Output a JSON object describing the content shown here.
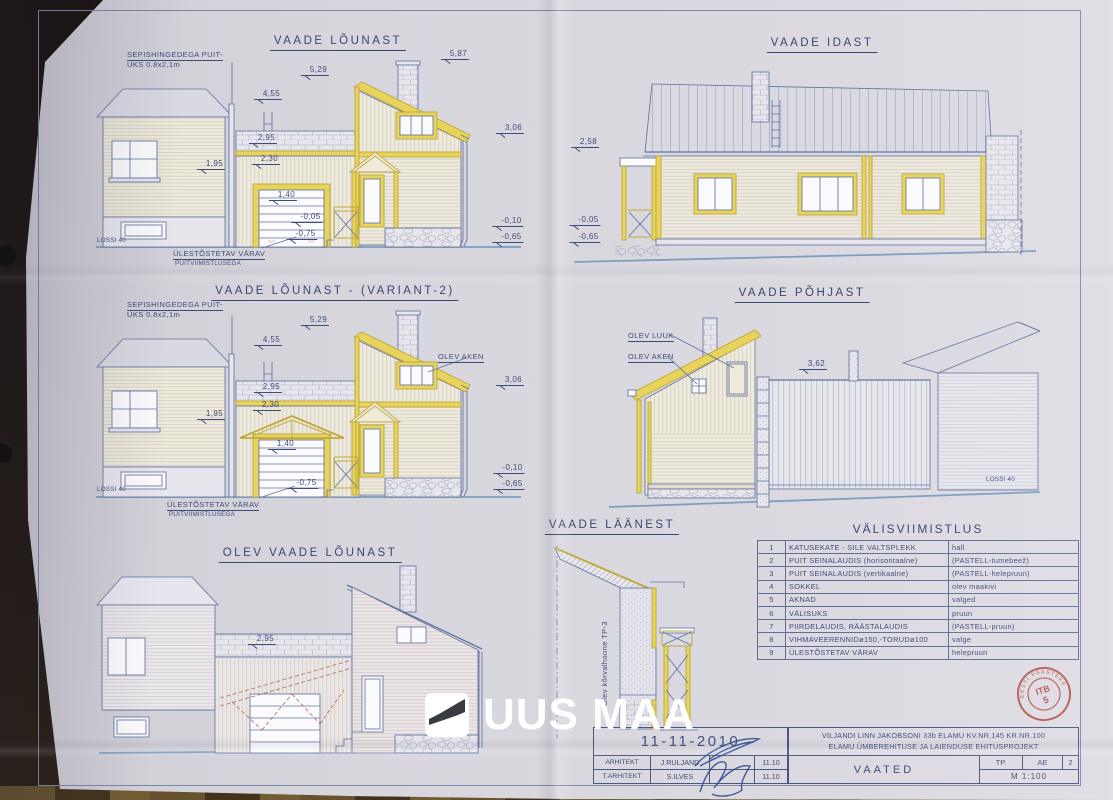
{
  "logo": {
    "text": "UUS MAA"
  },
  "stamp": {
    "line1": "ITB",
    "line2": "5",
    "arc": "EESTI PÄÄSTEKESKUS"
  },
  "finish_table": {
    "title": "VÄLISVIIMISTLUS",
    "rows": [
      [
        "1",
        "KATUSEKATE - SILE VALTSPLEKK",
        "hall"
      ],
      [
        "2",
        "PUIT SEINALAUDIS (horisontaalne)",
        "(PASTELL-tumebeež)"
      ],
      [
        "3",
        "PUIT SEINALAUDIS (vertikaalne)",
        "(PASTELL-helepruun)"
      ],
      [
        "4",
        "SOKKEL",
        "olev maakivi"
      ],
      [
        "5",
        "AKNAD",
        "valged"
      ],
      [
        "6",
        "VÄLISUKS",
        "pruun"
      ],
      [
        "7",
        "PIIRDELAUDIS, RÄÄSTALAUDIS",
        "(PASTELL-pruun)"
      ],
      [
        "8",
        "VIHMAVEERENNIDø150,-TORUDø100",
        "valge"
      ],
      [
        "9",
        "ÜLESTÕSTETAV VÄRAV",
        "helepruun"
      ]
    ]
  },
  "title_block": {
    "date": "11-11-2010",
    "arhitekt_label": "ARHITEKT",
    "arhitekt_name": "J.RULJAND",
    "arhitekt_date": "11.10",
    "t_arhitekt_label": "T.ARHITEKT",
    "t_arhitekt_name": "S.ILVES",
    "t_arhitekt_date": "11.10",
    "project_line1": "VILJANDI LINN   JAKOBSONI 33b ELAMU KV.NR.145 KR.NR.100",
    "project_line2": "ELAMU ÜMBEREHITUSE JA LAIENDUSE   EHITUSPROJEKT",
    "sheet_title": "VAATED",
    "stage": "TP.",
    "doc_type": "AE",
    "sheet_no": "2",
    "scale": "M 1:100"
  },
  "annotations": [
    {
      "name": "view-title-vaade-lounast",
      "text": "VAADE LÕUNAST",
      "x": 338,
      "y": 36,
      "cls": "vtitle",
      "al": "c"
    },
    {
      "name": "view-title-vaade-idast",
      "text": "VAADE IDAST",
      "x": 822,
      "y": 38,
      "cls": "vtitle",
      "al": "c"
    },
    {
      "name": "view-title-variant2",
      "text": "VAADE LÕUNAST - (VARIANT-2)",
      "x": 335,
      "y": 286,
      "cls": "vtitle",
      "al": "c"
    },
    {
      "name": "view-title-vaade-pohjast",
      "text": "VAADE PÕHJAST",
      "x": 802,
      "y": 288,
      "cls": "vtitle",
      "al": "c"
    },
    {
      "name": "view-title-olev-vaade-lounast",
      "text": "OLEV VAADE LÕUNAST",
      "x": 310,
      "y": 548,
      "cls": "vtitle",
      "al": "c"
    },
    {
      "name": "view-title-vaade-laanest",
      "text": "VAADE LÄÄNEST",
      "x": 612,
      "y": 520,
      "cls": "vtitle",
      "al": "c"
    },
    {
      "name": "label-sepis-uks-line1",
      "text": "SEPISHINGEDEGA PUIT-",
      "x": 127,
      "y": 51,
      "cls": "lbl u",
      "al": "l"
    },
    {
      "name": "label-sepis-uks-line2",
      "text": "UKS 0.8x2,1m",
      "x": 127,
      "y": 61,
      "cls": "lbl",
      "al": "l"
    },
    {
      "name": "dim-label",
      "text": "5,87",
      "x": 455,
      "y": 50,
      "cls": "dim",
      "al": "c"
    },
    {
      "name": "dim-label",
      "text": "5,29",
      "x": 315,
      "y": 66,
      "cls": "dim",
      "al": "c"
    },
    {
      "name": "dim-label",
      "text": "4,55",
      "x": 268,
      "y": 90,
      "cls": "dim",
      "al": "c"
    },
    {
      "name": "dim-label",
      "text": "2,95",
      "x": 263,
      "y": 134,
      "cls": "dim",
      "al": "c"
    },
    {
      "name": "dim-label",
      "text": "2,30",
      "x": 266,
      "y": 155,
      "cls": "dim",
      "al": "c"
    },
    {
      "name": "dim-label",
      "text": "1,95",
      "x": 211,
      "y": 160,
      "cls": "dim",
      "al": "c"
    },
    {
      "name": "dim-label",
      "text": "1,40",
      "x": 283,
      "y": 191,
      "cls": "dim",
      "al": "c"
    },
    {
      "name": "dim-label",
      "text": "-0,05",
      "x": 307,
      "y": 213,
      "cls": "dim",
      "al": "c"
    },
    {
      "name": "dim-label",
      "text": "-0,75",
      "x": 302,
      "y": 230,
      "cls": "dim",
      "al": "c"
    },
    {
      "name": "dim-label",
      "text": "3,06",
      "x": 510,
      "y": 124,
      "cls": "dim",
      "al": "c"
    },
    {
      "name": "dim-label",
      "text": "-0,10",
      "x": 508,
      "y": 217,
      "cls": "dim",
      "al": "c"
    },
    {
      "name": "dim-label",
      "text": "-0,65",
      "x": 508,
      "y": 233,
      "cls": "dim",
      "al": "c"
    },
    {
      "name": "label-ulestostetav-varav",
      "text": "ÜLESTÕSTETAV VÄRAV",
      "x": 173,
      "y": 250,
      "cls": "lbl u",
      "al": "l"
    },
    {
      "name": "label-puitviimistlusega",
      "text": "PUITVIIMISTLUSEGA",
      "x": 175,
      "y": 261,
      "cls": "sm",
      "al": "l"
    },
    {
      "name": "label-lossi-40",
      "text": "LOSSI 40",
      "x": 97,
      "y": 238,
      "cls": "sm",
      "al": "l"
    },
    {
      "name": "dim-label",
      "text": "2,58",
      "x": 585,
      "y": 138,
      "cls": "dim",
      "al": "c"
    },
    {
      "name": "dim-label",
      "text": "-0,05",
      "x": 585,
      "y": 216,
      "cls": "dim",
      "al": "c"
    },
    {
      "name": "dim-label",
      "text": "-0,65",
      "x": 585,
      "y": 233,
      "cls": "dim",
      "al": "c"
    },
    {
      "name": "label-sepis-uks2-line1",
      "text": "SEPISHINGEDEGA PUIT-",
      "x": 127,
      "y": 301,
      "cls": "lbl u",
      "al": "l"
    },
    {
      "name": "label-sepis-uks2-line2",
      "text": "UKS 0.8x2,1m",
      "x": 127,
      "y": 311,
      "cls": "lbl",
      "al": "l"
    },
    {
      "name": "dim-label",
      "text": "5,29",
      "x": 315,
      "y": 316,
      "cls": "dim",
      "al": "c"
    },
    {
      "name": "dim-label",
      "text": "4,55",
      "x": 268,
      "y": 336,
      "cls": "dim",
      "al": "c"
    },
    {
      "name": "label-olev-aken",
      "text": "OLEV AKEN",
      "x": 438,
      "y": 353,
      "cls": "lbl u",
      "al": "l"
    },
    {
      "name": "dim-label",
      "text": "3,06",
      "x": 510,
      "y": 376,
      "cls": "dim",
      "al": "c"
    },
    {
      "name": "dim-label",
      "text": "2,95",
      "x": 268,
      "y": 383,
      "cls": "dim",
      "al": "c"
    },
    {
      "name": "dim-label",
      "text": "2,30",
      "x": 267,
      "y": 401,
      "cls": "dim",
      "al": "c"
    },
    {
      "name": "dim-label",
      "text": "1,95",
      "x": 211,
      "y": 410,
      "cls": "dim",
      "al": "c"
    },
    {
      "name": "dim-label",
      "text": "1,40",
      "x": 282,
      "y": 440,
      "cls": "dim",
      "al": "c"
    },
    {
      "name": "dim-label",
      "text": "-0,75",
      "x": 303,
      "y": 479,
      "cls": "dim",
      "al": "c"
    },
    {
      "name": "dim-label",
      "text": "-0,10",
      "x": 509,
      "y": 464,
      "cls": "dim",
      "al": "c"
    },
    {
      "name": "dim-label",
      "text": "-0,65",
      "x": 509,
      "y": 480,
      "cls": "dim",
      "al": "c"
    },
    {
      "name": "label-ulestostetav-varav2",
      "text": "ÜLESTÕSTETAV VÄRAV",
      "x": 167,
      "y": 501,
      "cls": "lbl u",
      "al": "l"
    },
    {
      "name": "label-puitviimistlusega2",
      "text": "PUITVIIMISTLUSEGA",
      "x": 169,
      "y": 512,
      "cls": "sm",
      "al": "l"
    },
    {
      "name": "label-lossi-40-2",
      "text": "LOSSI 40",
      "x": 97,
      "y": 487,
      "cls": "sm",
      "al": "l"
    },
    {
      "name": "label-olev-luuk",
      "text": "OLEV LUUK",
      "x": 628,
      "y": 332,
      "cls": "lbl u",
      "al": "l"
    },
    {
      "name": "label-olev-aken-pohjast",
      "text": "OLEV AKEN",
      "x": 628,
      "y": 353,
      "cls": "lbl u",
      "al": "l"
    },
    {
      "name": "dim-label",
      "text": "3,62",
      "x": 813,
      "y": 360,
      "cls": "dim",
      "al": "c"
    },
    {
      "name": "label-lossi-40-3",
      "text": "LOSSI 40",
      "x": 986,
      "y": 477,
      "cls": "sm",
      "al": "l"
    },
    {
      "name": "dim-label",
      "text": "2,95",
      "x": 262,
      "y": 635,
      "cls": "dim",
      "al": "c"
    },
    {
      "name": "label-olev-korvalhoone",
      "text": "Olev kõrvalhoone TP-3",
      "x": 601,
      "y": 706,
      "cls": "vert",
      "al": "l"
    }
  ]
}
